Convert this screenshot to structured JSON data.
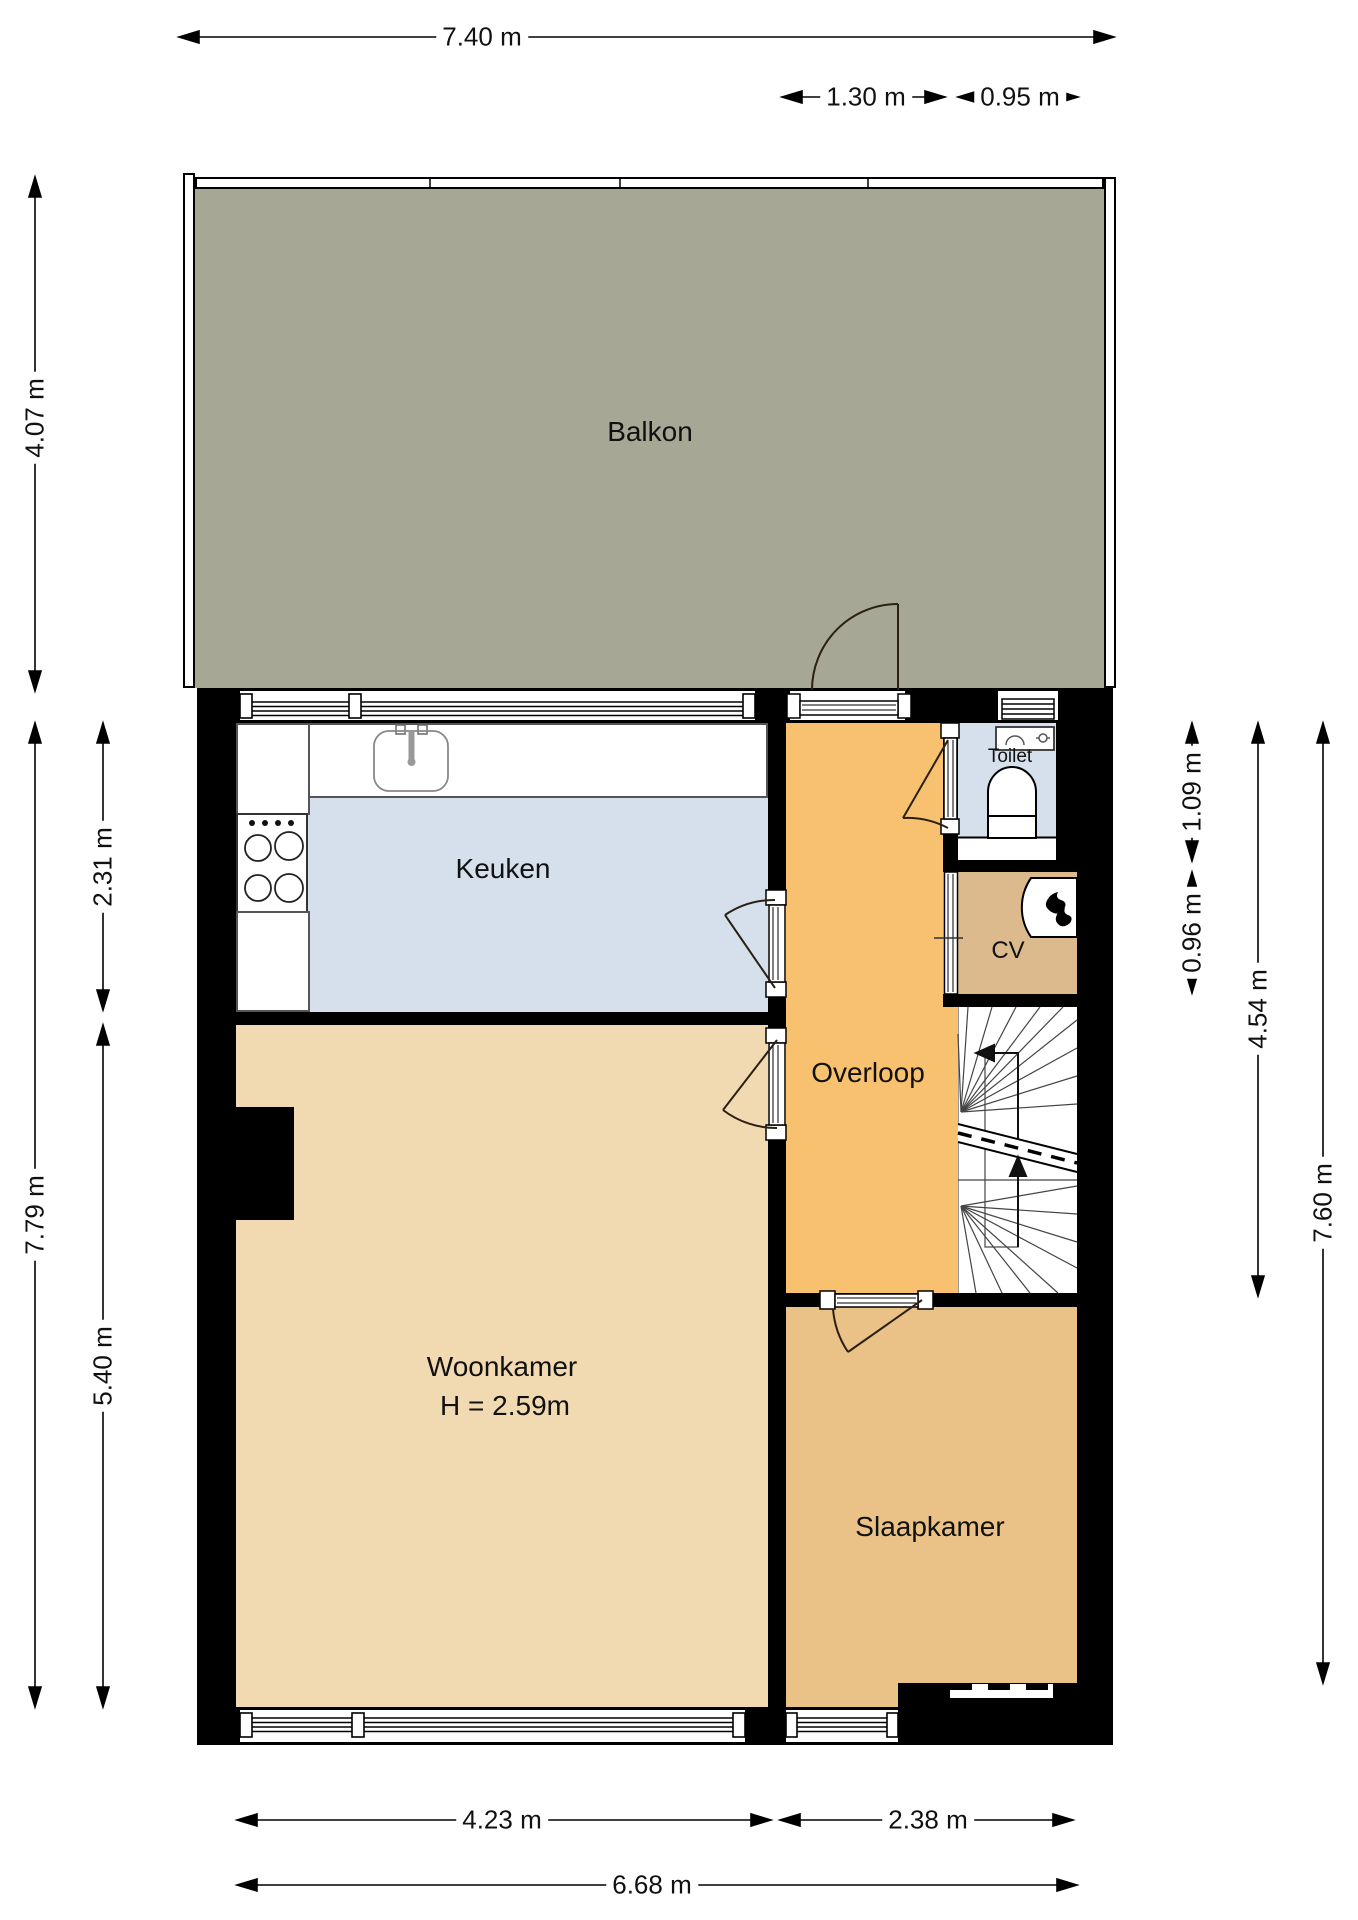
{
  "plan": {
    "rooms": {
      "balkon": {
        "label": "Balkon"
      },
      "keuken": {
        "label": "Keuken"
      },
      "toilet": {
        "label": "Toilet"
      },
      "cv": {
        "label": "CV"
      },
      "overloop": {
        "label": "Overloop"
      },
      "woonkamer": {
        "label": "Woonkamer",
        "ceiling_height": "H = 2.59m"
      },
      "slaapkamer": {
        "label": "Slaapkamer"
      }
    },
    "dimensions": {
      "top_total": "7.40 m",
      "top_overloop": "1.30 m",
      "top_toilet": "0.95 m",
      "left_balkon": "4.07 m",
      "left_keuken": "2.31 m",
      "left_total": "7.79 m",
      "left_woonkamer": "5.40 m",
      "right_toilet": "1.09 m",
      "right_cv": "0.96 m",
      "right_hall": "4.54 m",
      "right_total": "7.60 m",
      "bottom_woonkamer": "4.23 m",
      "bottom_slaapkamer": "2.38 m",
      "bottom_total": "6.68 m"
    },
    "colors": {
      "balkon_floor": "#a7a796",
      "keuken_floor": "#d5e0ec",
      "toilet_floor": "#d5e0ec",
      "overloop_floor": "#f7c16f",
      "woonkamer_floor": "#f1dab1",
      "slaapkamer_floor": "#eac287",
      "cv_floor": "#dcba8d",
      "wall": "#000000",
      "dimension_text": "#111111"
    },
    "icons": {
      "sink": "kitchen sink with faucet",
      "stove": "4-burner cooktop",
      "toilet_bowl": "toilet",
      "washbasin": "hand basin with faucet",
      "boiler_flame": "central-heating boiler flame mark",
      "stair_arrows": "stair direction arrows",
      "door_swing": "door swing arcs"
    }
  }
}
